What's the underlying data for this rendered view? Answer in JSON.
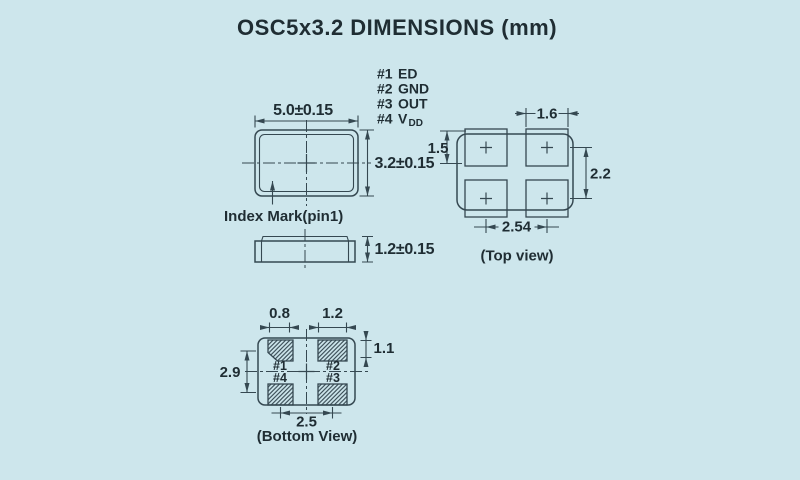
{
  "title": "OSC5x3.2  DIMENSIONS (mm)",
  "colors": {
    "background": "#cde6ec",
    "line": "#354851",
    "text": "#1f2d33"
  },
  "pin_functions": [
    {
      "num": "#1",
      "name": "ED"
    },
    {
      "num": "#2",
      "name": "GND"
    },
    {
      "num": "#3",
      "name": "OUT"
    },
    {
      "num": "#4",
      "name": "V",
      "name_sub": "DD"
    }
  ],
  "front_view": {
    "width_dim": "5.0±0.15",
    "height_dim": "3.2±0.15",
    "index_mark_label": "Index Mark(pin1)"
  },
  "side_view": {
    "height_dim": "1.2±0.15"
  },
  "top_view": {
    "caption": "(Top view)",
    "pad_width_dim": "1.6",
    "pad_height_dim": "1.5",
    "pad_pitch_vertical_dim": "2.2",
    "pad_pitch_horizontal_dim": "2.54"
  },
  "bottom_view": {
    "caption": "(Bottom View)",
    "pad1_width_dim": "0.8",
    "pad2_width_dim": "1.2",
    "pad_height_dim": "1.1",
    "body_height_dim": "2.9",
    "pad_pitch_dim": "2.5",
    "pads": [
      "#1",
      "#2",
      "#4",
      "#3"
    ]
  }
}
